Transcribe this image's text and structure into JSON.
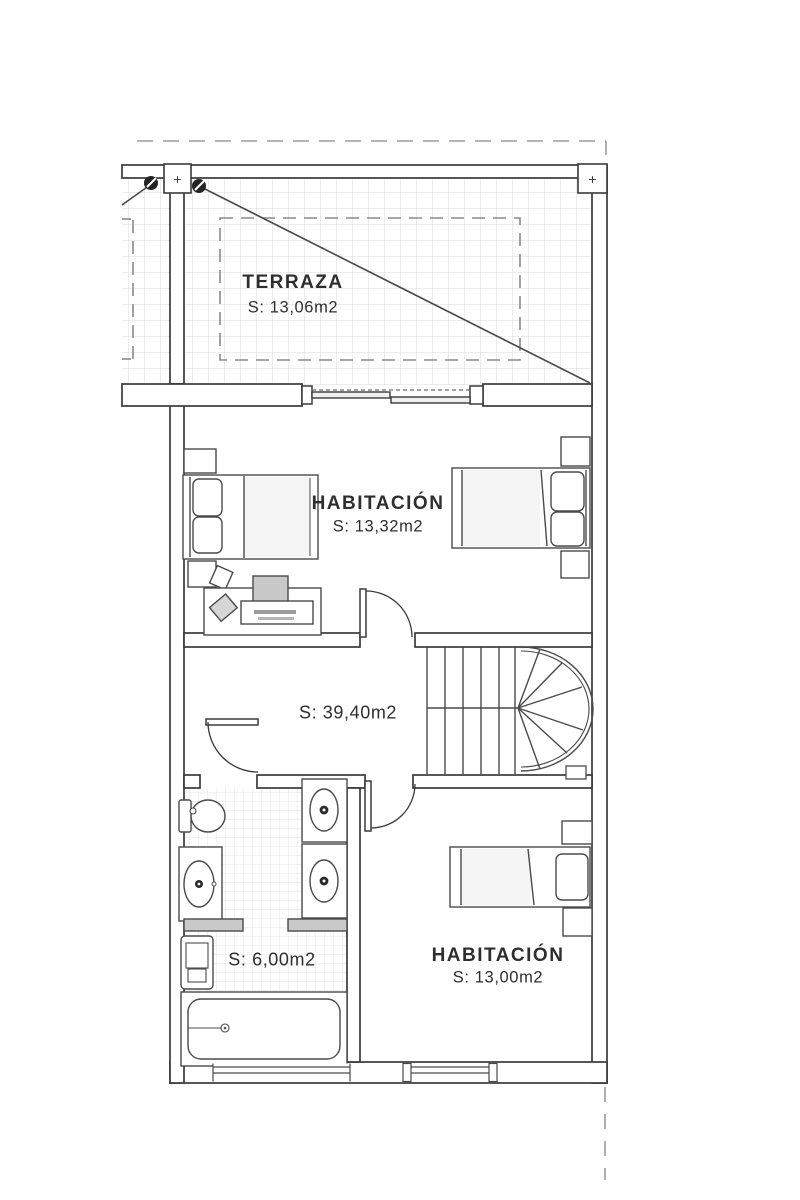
{
  "rooms": {
    "terraza": {
      "name": "TERRAZA",
      "area": "S: 13,06m2"
    },
    "habitacion1": {
      "name": "HABITACIÓN",
      "area": "S: 13,32m2"
    },
    "distribuidor": {
      "area": "S: 39,40m2"
    },
    "bano": {
      "area": "S: 6,00m2"
    },
    "habitacion2": {
      "name": "HABITACIÓN",
      "area": "S: 13,00m2"
    }
  },
  "markers": {
    "column_symbol": "+"
  },
  "colors": {
    "line": "#3a3a3a",
    "grid_large": "#d9d9d9",
    "grid_small": "#e4e4e4",
    "dash": "#9b9b9b",
    "fixture_dark": "#242424"
  }
}
